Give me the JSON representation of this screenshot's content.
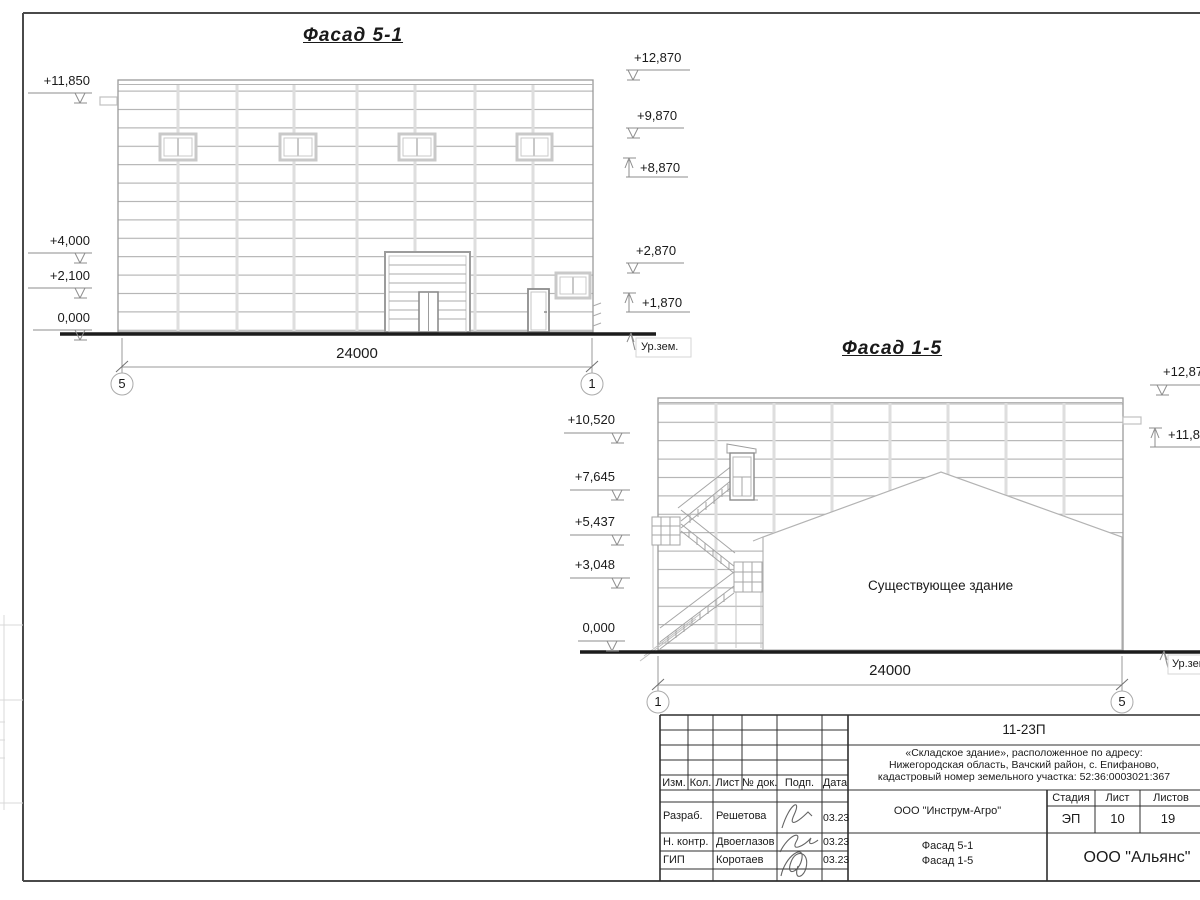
{
  "facade51": {
    "title": "Фасад 5-1",
    "marks_left": [
      "+11,850",
      "+4,000",
      "+2,100",
      "0,000"
    ],
    "marks_right": [
      "+12,870",
      "+9,870",
      "+8,870",
      "+2,870",
      "+1,870"
    ],
    "dimension": "24000",
    "axis_start": "5",
    "axis_end": "1",
    "ground_label": "Ур.зем."
  },
  "facade15": {
    "title": "Фасад 1-5",
    "marks_left": [
      "+10,520",
      "+7,645",
      "+5,437",
      "+3,048",
      "0,000"
    ],
    "marks_right": [
      "+12,870",
      "+11,850"
    ],
    "dimension": "24000",
    "axis_start": "1",
    "axis_end": "5",
    "ground_label": "Ур.зем",
    "existing_building_label": "Существующее здание"
  },
  "title_block": {
    "doc_number": "11-23П",
    "project_line1": "«Складское здание», расположенное по адресу:",
    "project_line2": "Нижегородская область, Вачский район, с. Епифаново,",
    "project_line3": "кадастровый номер земельного участка: 52:36:0003021:367",
    "col_izm": "Изм.",
    "col_kol": "Кол.",
    "col_list": "Лист",
    "col_doc": "№ док.",
    "col_podp": "Подп.",
    "col_data": "Дата",
    "row1_role": "Разраб.",
    "row1_name": "Решетова",
    "row1_date": "03.23",
    "row2_role": "Н. контр.",
    "row2_name": "Двоеглазов",
    "row2_date": "03.23",
    "row3_role": "ГИП",
    "row3_name": "Коротаев",
    "row3_date": "03.23",
    "org_name": "ООО \"Инструм-Агро\"",
    "stage_label": "Стадия",
    "sheet_label": "Лист",
    "sheets_label": "Листов",
    "stage_value": "ЭП",
    "sheet_value": "10",
    "sheets_value": "19",
    "drawing_title_line1": "Фасад 5-1",
    "drawing_title_line2": "Фасад 1-5",
    "company_name": "ООО \"Альянс\""
  }
}
